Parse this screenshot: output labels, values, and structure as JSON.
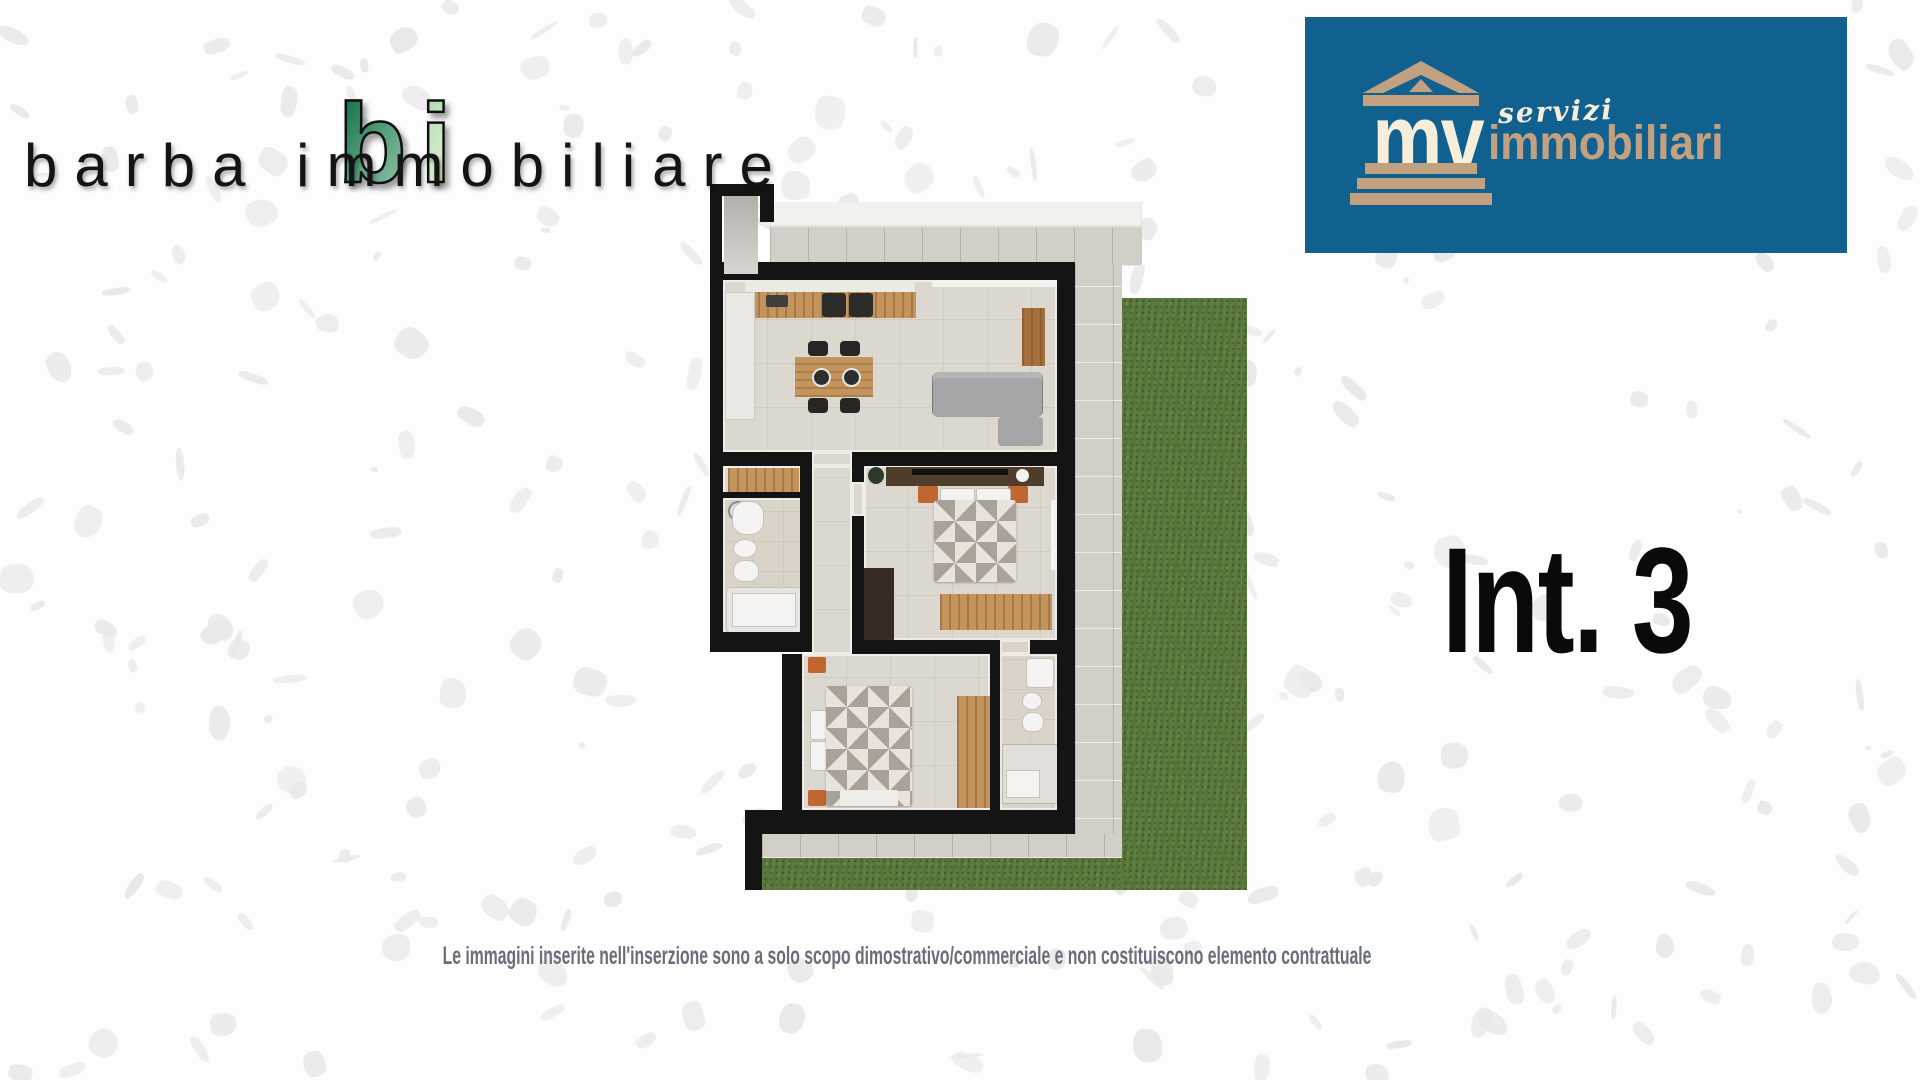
{
  "brand_barba": {
    "monogram_b": "b",
    "monogram_i": "i",
    "wordmark": "barba immobiliare"
  },
  "brand_mv": {
    "monogram": "mv",
    "tagline_script": "servizi",
    "tagline_main": "immobiliari"
  },
  "unit_label": "Int. 3",
  "disclaimer": "Le immagini inserite nell'inserzione sono a solo scopo dimostrativo/commerciale e non costituiscono elemento contrattuale",
  "colors": {
    "page-bg": "#fdfdfd",
    "speckle-gray": "#e9e9e9",
    "banner-blue": "#10618f",
    "logo-tan": "#c2a181",
    "logo-cream": "#f6eed8",
    "monogram-green-dark": "#0e6a45",
    "monogram-green-light": "#cde8c6",
    "ink": "#141414",
    "disclaimer-gray": "#6a6e7a",
    "wall-black": "#141414",
    "floor-beige": "#ddd8cf",
    "terrace-gray": "#d2cfc8",
    "grass-green": "#5e7c3f",
    "wood": "#c3945c",
    "wood-dark": "#503e2c",
    "sofa-gray": "#a5a5a7",
    "fixture-white": "#f4f3f1",
    "accent-orange": "#c2662f"
  }
}
